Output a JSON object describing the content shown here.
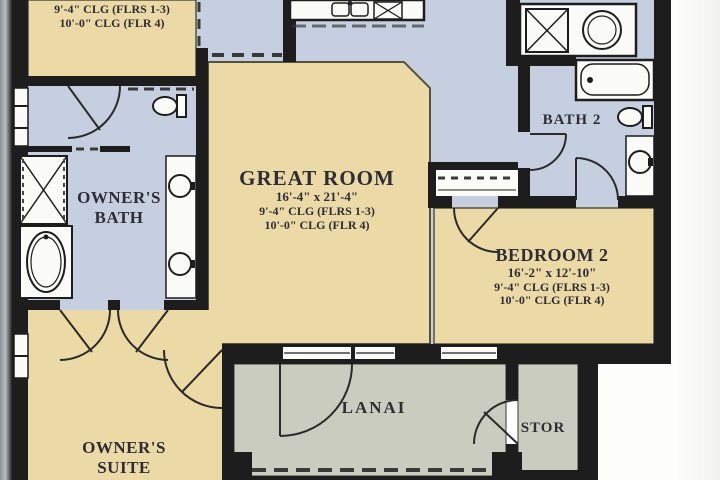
{
  "plan": {
    "rooms": {
      "retreat": {
        "dim": "12'-2\" x 12'-8\"",
        "clg1": "9'-4\" CLG (FLRS 1-3)",
        "clg2": "10'-0\" CLG (FLR 4)"
      },
      "great_room": {
        "name": "GREAT ROOM",
        "dim": "16'-4\" x 21'-4\"",
        "clg1": "9'-4\" CLG (FLRS 1-3)",
        "clg2": "10'-0\" CLG (FLR 4)"
      },
      "owners_bath": {
        "name_line1": "OWNER'S",
        "name_line2": "BATH"
      },
      "bath2": {
        "name": "BATH 2"
      },
      "bedroom2": {
        "name": "BEDROOM 2",
        "dim": "16'-2\" x 12'-10\"",
        "clg1": "9'-4\" CLG (FLRS 1-3)",
        "clg2": "10'-0\" CLG (FLR 4)"
      },
      "lanai": {
        "name": "LANAI"
      },
      "stor": {
        "name": "STOR"
      },
      "owners_suite": {
        "name_line1": "OWNER'S",
        "name_line2": "SUITE"
      }
    },
    "colors": {
      "room_tan": "#ebdaa6",
      "wet_area_blue": "#c6cfe0",
      "outdoor_gray_green": "#c9ccbf",
      "wall_black": "#1d1d1d",
      "fixture_white": "#fbfbf8",
      "text": "#2e2d36",
      "page_edge_gray": "#8b9196"
    }
  }
}
